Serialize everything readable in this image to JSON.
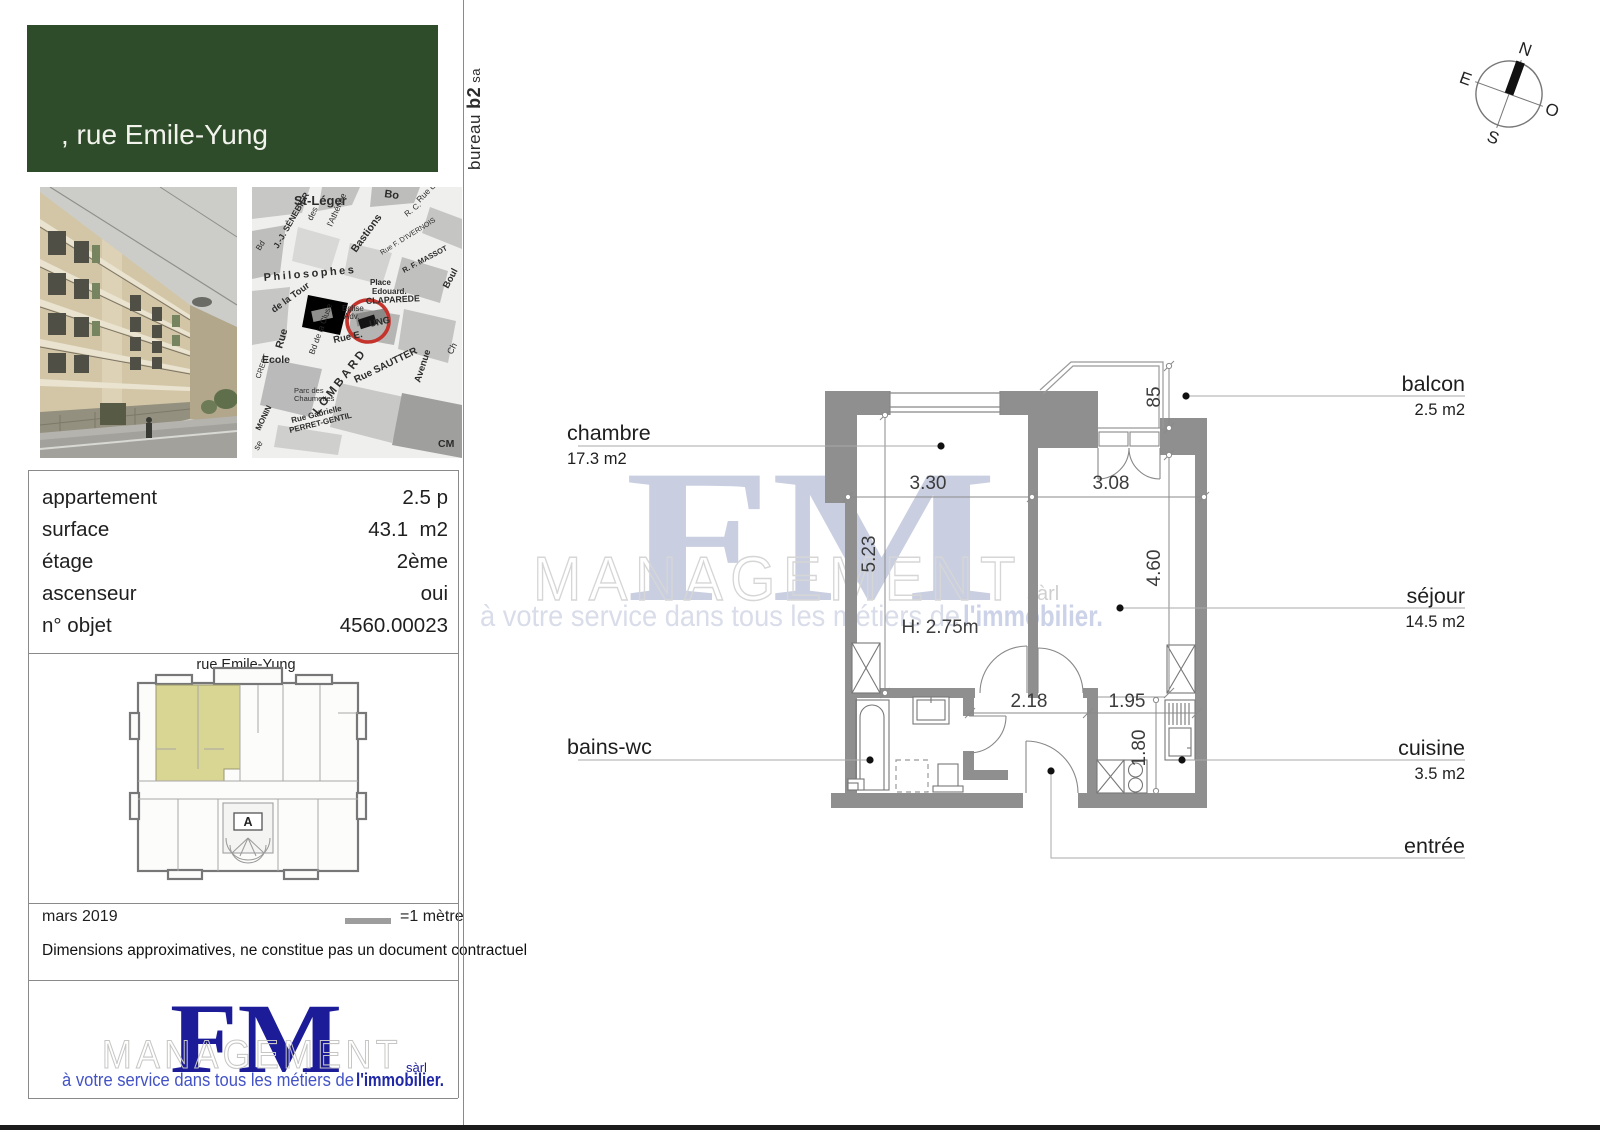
{
  "header": {
    "line1": ", rue Emile-Yung",
    "line2": "1205 Genève",
    "line3": "Philosophes"
  },
  "bureau": {
    "word": "bureau ",
    "bold": "b2",
    "suffix": " sa"
  },
  "info": {
    "rows": [
      {
        "label": "appartement",
        "value": "2.5 p"
      },
      {
        "label": "surface",
        "value": "43.1  m2"
      },
      {
        "label": "étage",
        "value": "2ème"
      },
      {
        "label": "ascenseur",
        "value": "oui"
      },
      {
        "label": "n° objet",
        "value": "4560.00023"
      }
    ]
  },
  "mini_plan": {
    "street": "rue Emile-Yung",
    "stair": "A"
  },
  "footer": {
    "date": "mars 2019",
    "scale": "=1 mètre",
    "disclaimer": "Dimensions approximatives, ne constitue pas un document contractuel"
  },
  "logo": {
    "fm": "FM",
    "management": "MANAGEMENT",
    "sarl": "sàrl",
    "tagline": "à votre service dans tous les métiers de ",
    "tagline_bold": "l'immobilier."
  },
  "compass": {
    "n": "N",
    "e": "E",
    "s": "S",
    "o": "O"
  },
  "plan": {
    "labels": [
      {
        "name": "chambre",
        "area": "17.3 m2"
      },
      {
        "name": "balcon",
        "area": "2.5 m2"
      },
      {
        "name": "séjour",
        "area": "14.5 m2"
      },
      {
        "name": "cuisine",
        "area": "3.5 m2"
      },
      {
        "name": "bains-wc",
        "area": ""
      },
      {
        "name": "entrée",
        "area": ""
      }
    ],
    "dims": {
      "chambre_width": "3.30",
      "sejour_width": "3.08",
      "chambre_depth": "5.23",
      "sejour_depth": "4.60",
      "hall_width": "2.18",
      "cuisine_width": "1.95",
      "cuisine_depth": "1.80",
      "balcon_depth": "85",
      "ceiling_height": "H: 2.75m"
    }
  },
  "map": {
    "streets": [
      "St-Léger",
      "J.-J. SÉNEBIER",
      "Bd",
      "des",
      "Bastions",
      "l'Athénée",
      "Bo",
      "Rue de",
      "R. C.",
      "Rue F. D'IVERNOIS",
      "R. F. MASSOT",
      "Philosophes",
      "de la Tour",
      "Rue",
      "Place",
      "Edouard.",
      "CLAPAREDE",
      "Eglise",
      "Adv.",
      "Rue E.",
      "UNG",
      "Bd de la Cluse",
      "Ecole",
      "LOMBARD",
      "Rue SAUTTER",
      "Avenue",
      "Parc des",
      "Chaumettes",
      "Rue Gabrielle",
      "PERRET-GENTIL",
      "MONIN",
      "CREST",
      "Boul",
      "CM",
      "se",
      "Ch"
    ]
  },
  "colors": {
    "green": "#2e4c29",
    "wall": "#8f8f8f",
    "highlight": "#d9d593",
    "navy": "#1c1c99",
    "blue": "#4353c6",
    "map_marker": "#c4332c"
  }
}
